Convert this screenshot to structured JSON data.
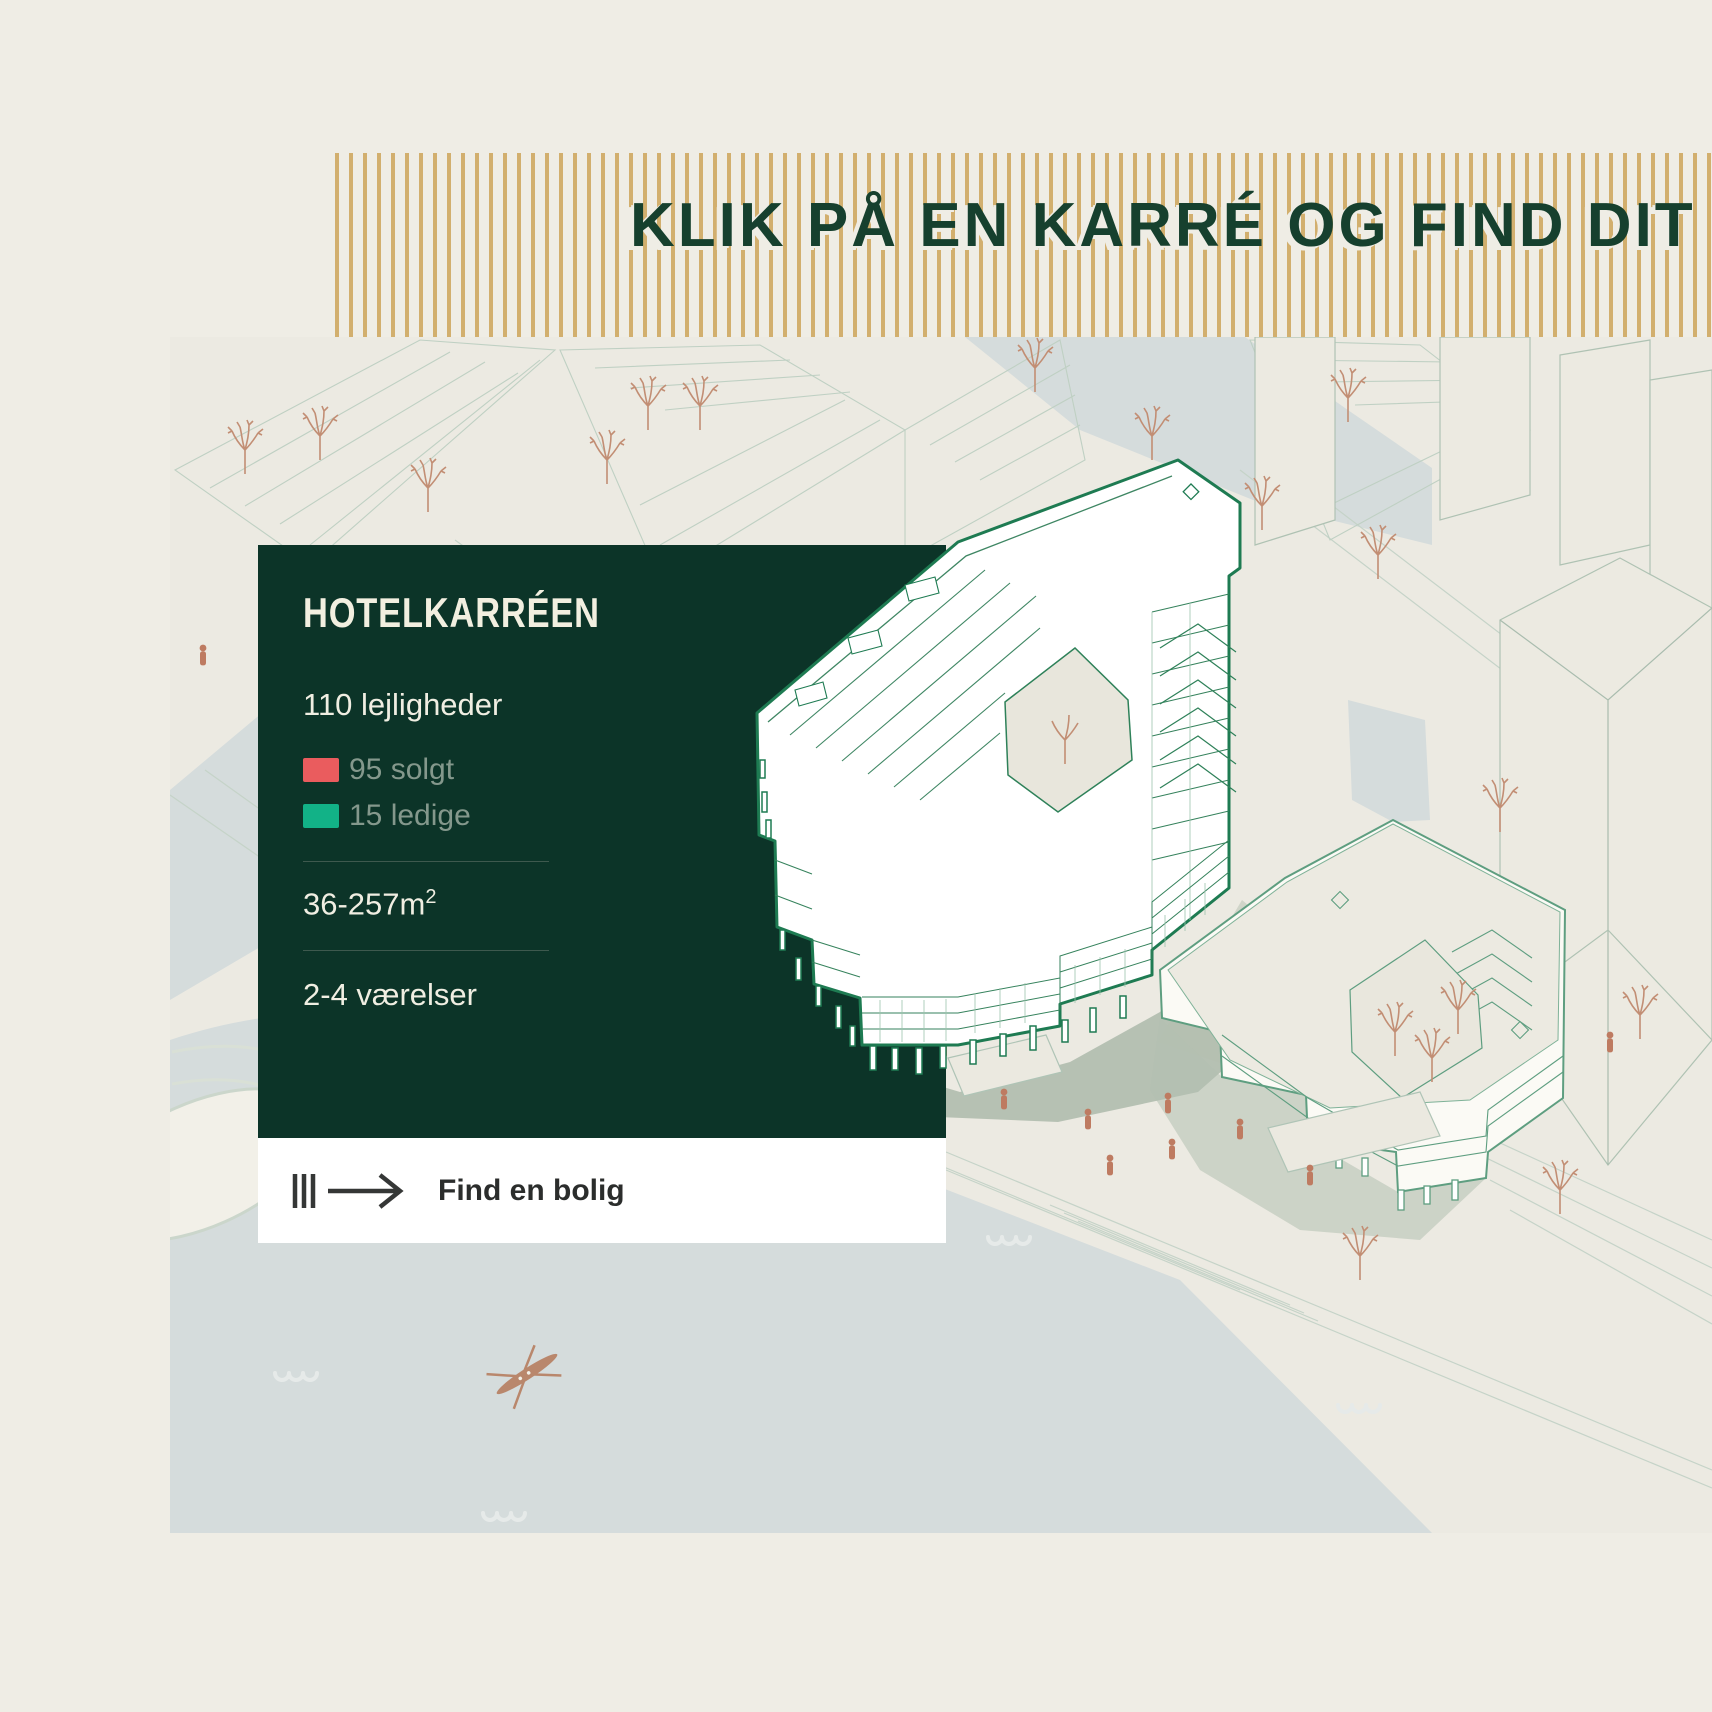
{
  "banner": {
    "title": "KLIK PÅ EN KARRÉ OG FIND DIT NYE HJEM"
  },
  "card": {
    "title": "HOTELKARRÉEN",
    "units_total": "110 lejligheder",
    "legend": [
      {
        "label": "95 solgt",
        "color": "#ea5c5e"
      },
      {
        "label": "15 ledige",
        "color": "#12b287"
      }
    ],
    "area_range": "36-257m",
    "area_superscript": "2",
    "rooms_range": "2-4 værelser"
  },
  "footer": {
    "cta_label": "Find en bolig"
  },
  "map": {
    "highlighted_building": "Hotelkarréen"
  },
  "colors": {
    "card_bg": "#0c3428",
    "banner_stripe_gold": "#d2af6e",
    "heading_green": "#16402e",
    "sold_red": "#ea5c5e",
    "available_teal": "#12b287",
    "water": "#d5dcdc",
    "building_outline": "#1e7b52",
    "map_background": "#eceae2"
  }
}
